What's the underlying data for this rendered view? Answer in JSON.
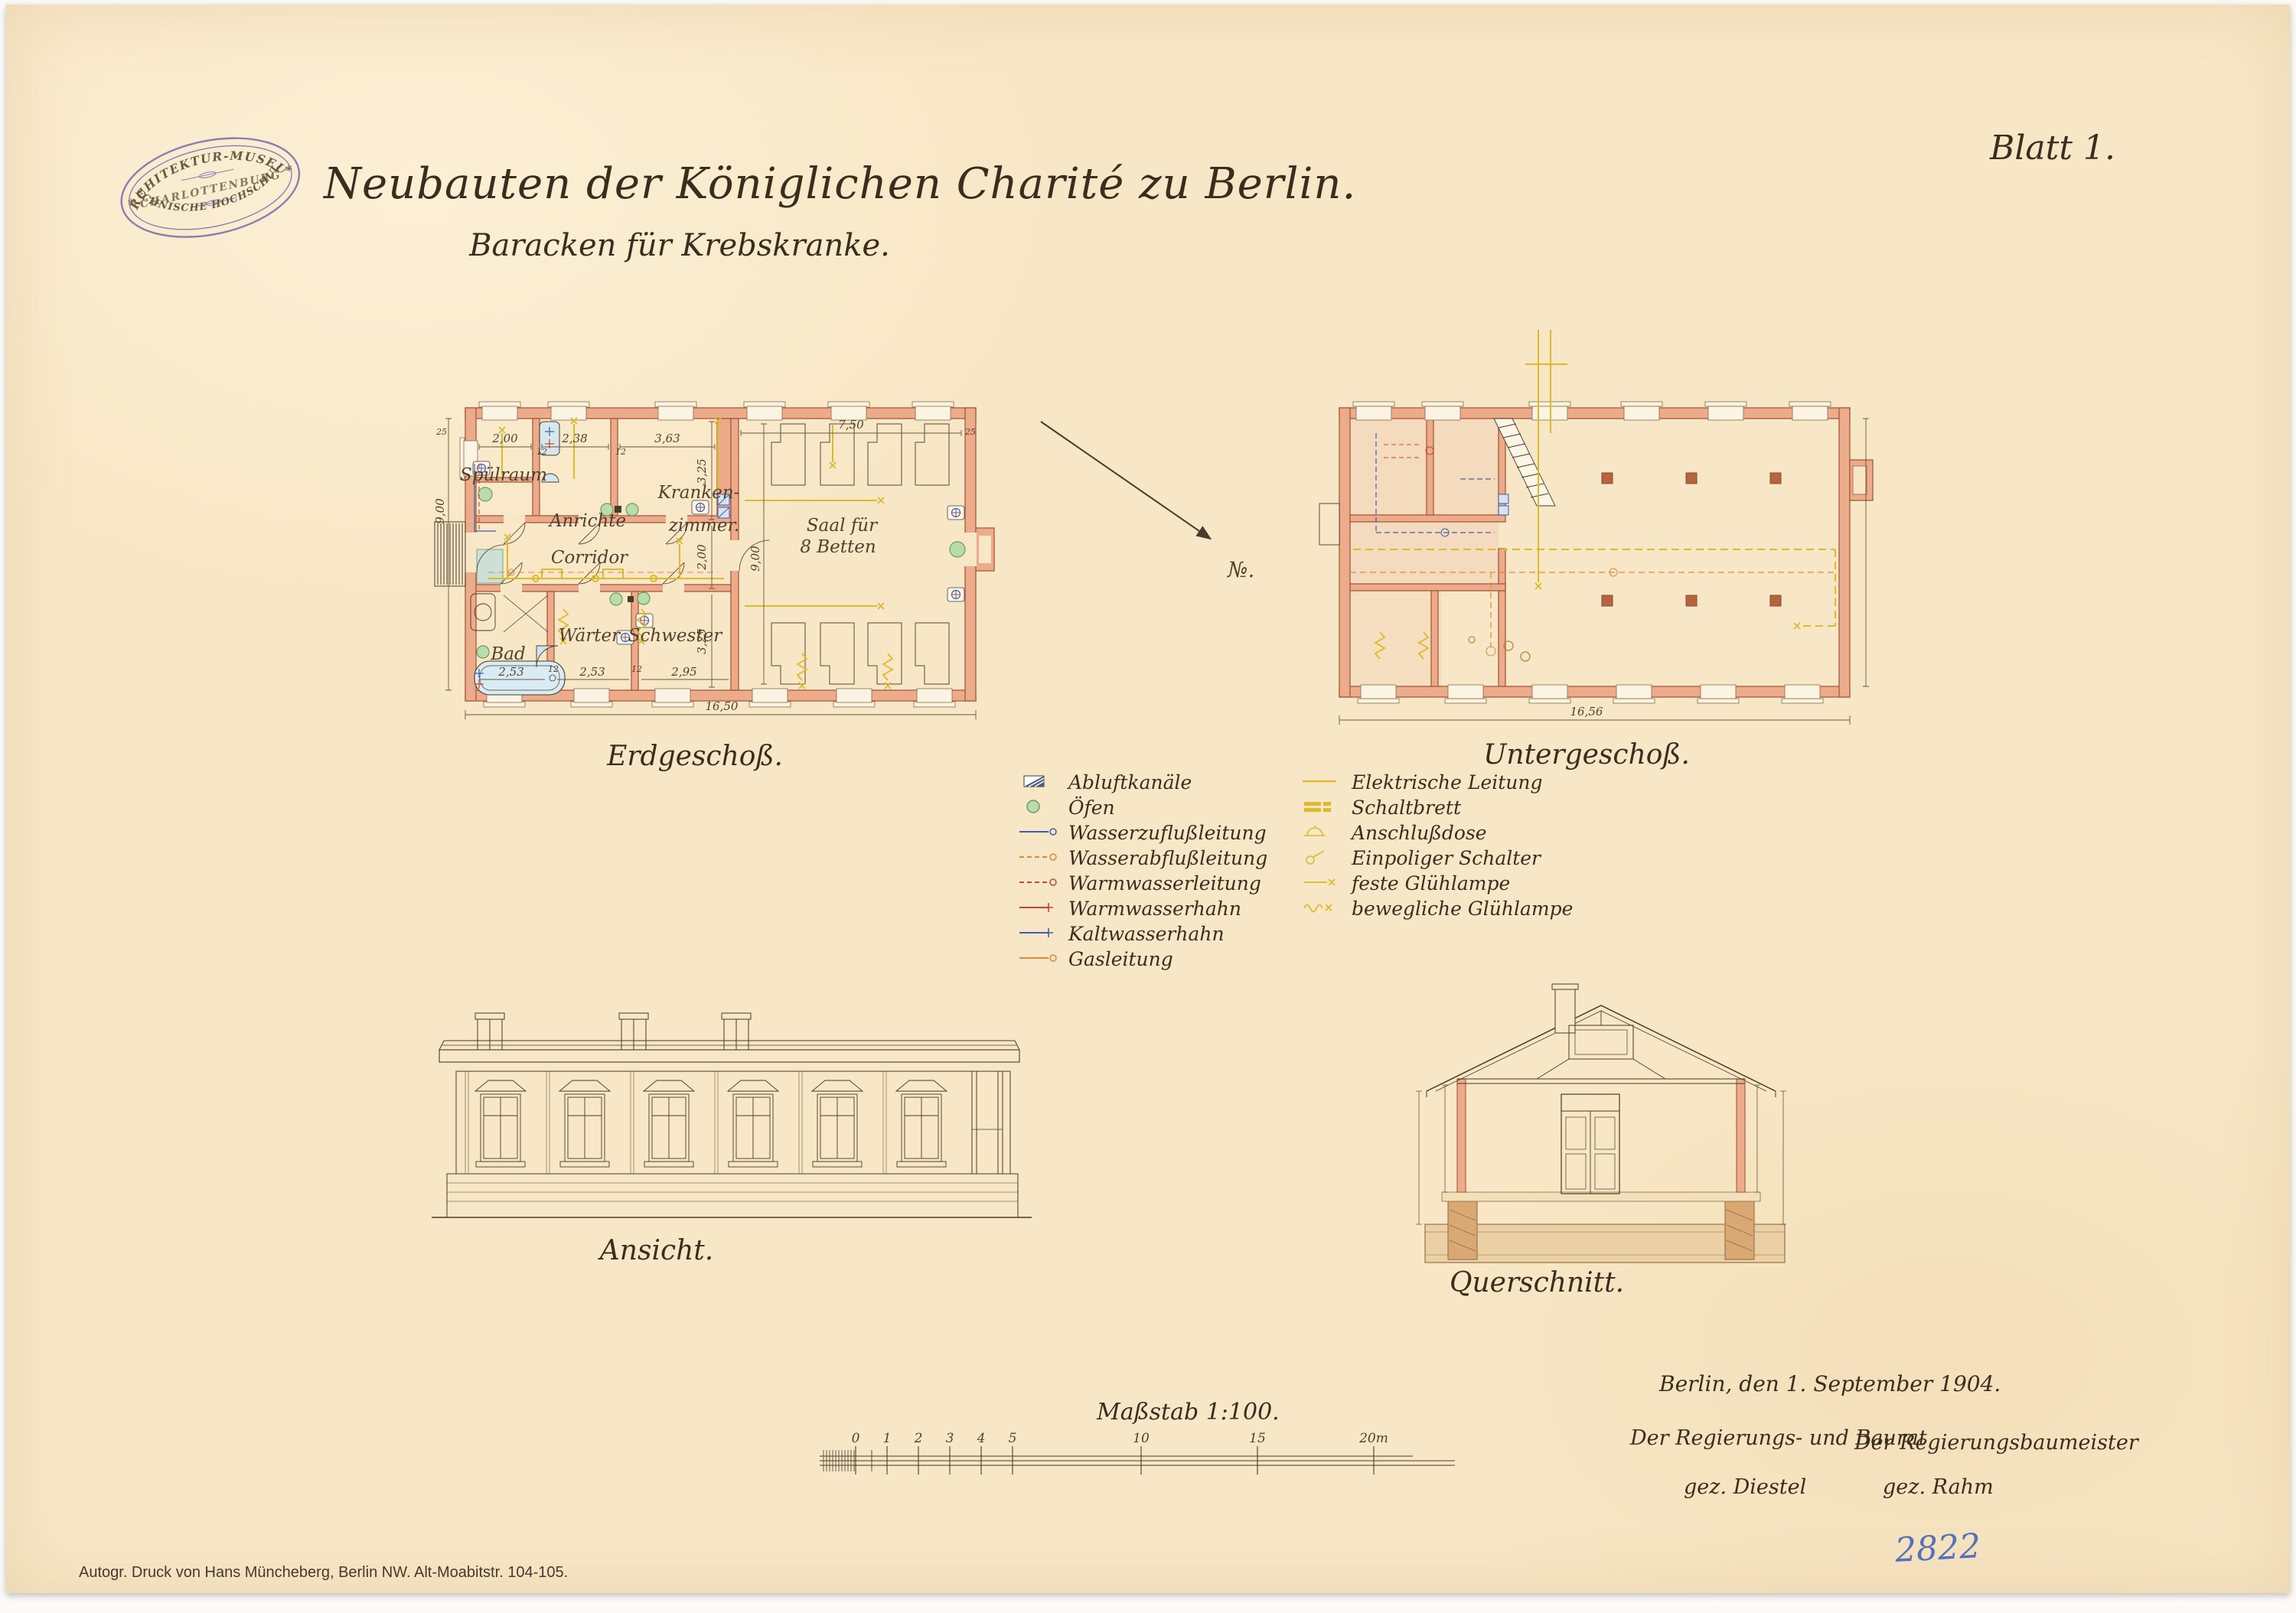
{
  "sheet": {
    "blatt_label": "Blatt 1.",
    "title": "Neubauten der Königlichen Charité zu Berlin.",
    "subtitle": "Baracken für Krebskranke.",
    "imprint": "Autogr. Druck von Hans Müncheberg, Berlin NW. Alt-Moabitstr. 104-105.",
    "inventory_number": "2822"
  },
  "stamp": {
    "arc_top": "ARCHITEKTUR-MUSEUM",
    "middle": "CHARLOTTENBURG",
    "arc_bottom": "TECHNISCHE HOCHSCHULE.",
    "star": "*"
  },
  "erdgeschoss": {
    "caption": "Erdgeschoß.",
    "rooms": {
      "spuelraum": "Spülraum",
      "anrichte": "Anrichte",
      "kranken_line1": "Kranken-",
      "kranken_line2": "zimmer.",
      "corridor": "Corridor",
      "bad": "Bad",
      "waerter": "Wärter",
      "schwester": "Schwester",
      "saal_line1": "Saal für",
      "saal_line2": "8 Betten"
    },
    "dims": {
      "spuelraum_w": "2,00",
      "anrichte_w": "2,38",
      "kranken_w": "3,63",
      "kranken_h": "3,25",
      "corridor_h": "2,00",
      "unten_h": "3,25",
      "saal_w": "7,50",
      "saal_h": "9,00",
      "height_left": "9,00",
      "bad_w": "2,53",
      "waerter_w": "2,53",
      "schwester_w": "2,95",
      "total_w": "16,50",
      "wall25": "25",
      "wall12": "12"
    }
  },
  "untergeschoss": {
    "caption": "Untergeschoß.",
    "dims": {
      "total_w": "16,56"
    }
  },
  "ansicht": {
    "caption": "Ansicht."
  },
  "querschnitt": {
    "caption": "Querschnitt."
  },
  "annotations": {
    "arrow_mark": "№."
  },
  "legend": {
    "left": [
      {
        "label": "Abluftkanäle"
      },
      {
        "label": "Öfen"
      },
      {
        "label": "Wasserzuflußleitung"
      },
      {
        "label": "Wasserabflußleitung"
      },
      {
        "label": "Warmwasserleitung"
      },
      {
        "label": "Warmwasserhahn"
      },
      {
        "label": "Kaltwasserhahn"
      },
      {
        "label": "Gasleitung"
      }
    ],
    "right": [
      {
        "label": "Elektrische Leitung"
      },
      {
        "label": "Schaltbrett"
      },
      {
        "label": "Anschlußdose"
      },
      {
        "label": "Einpoliger Schalter"
      },
      {
        "label": "feste Glühlampe"
      },
      {
        "label": "bewegliche Glühlampe"
      }
    ]
  },
  "scale": {
    "label": "Maßstab 1:100.",
    "ticks": [
      "0",
      "1",
      "2",
      "3",
      "4",
      "5",
      "10",
      "15",
      "20m"
    ]
  },
  "signature": {
    "date_line": "Berlin, den  1. September  1904.",
    "left_role": "Der Regierungs- und Baurat",
    "left_name": "gez. Diestel",
    "right_role": "Der Regierungsbaumeister",
    "right_name": "gez. Rahm"
  },
  "colors": {
    "wall_fill": "#ecab8b",
    "wall_line": "#a65a3a",
    "ink": "#4a3a28",
    "electric_yellow": "#ddba2b",
    "water_blue": "#3d5fae",
    "warm_red": "#c94434",
    "gas_orange": "#dd8a3d",
    "oven_green": "#b9dcab",
    "stamp_purple": "#8265b0",
    "paper": "#f8e7c6"
  }
}
